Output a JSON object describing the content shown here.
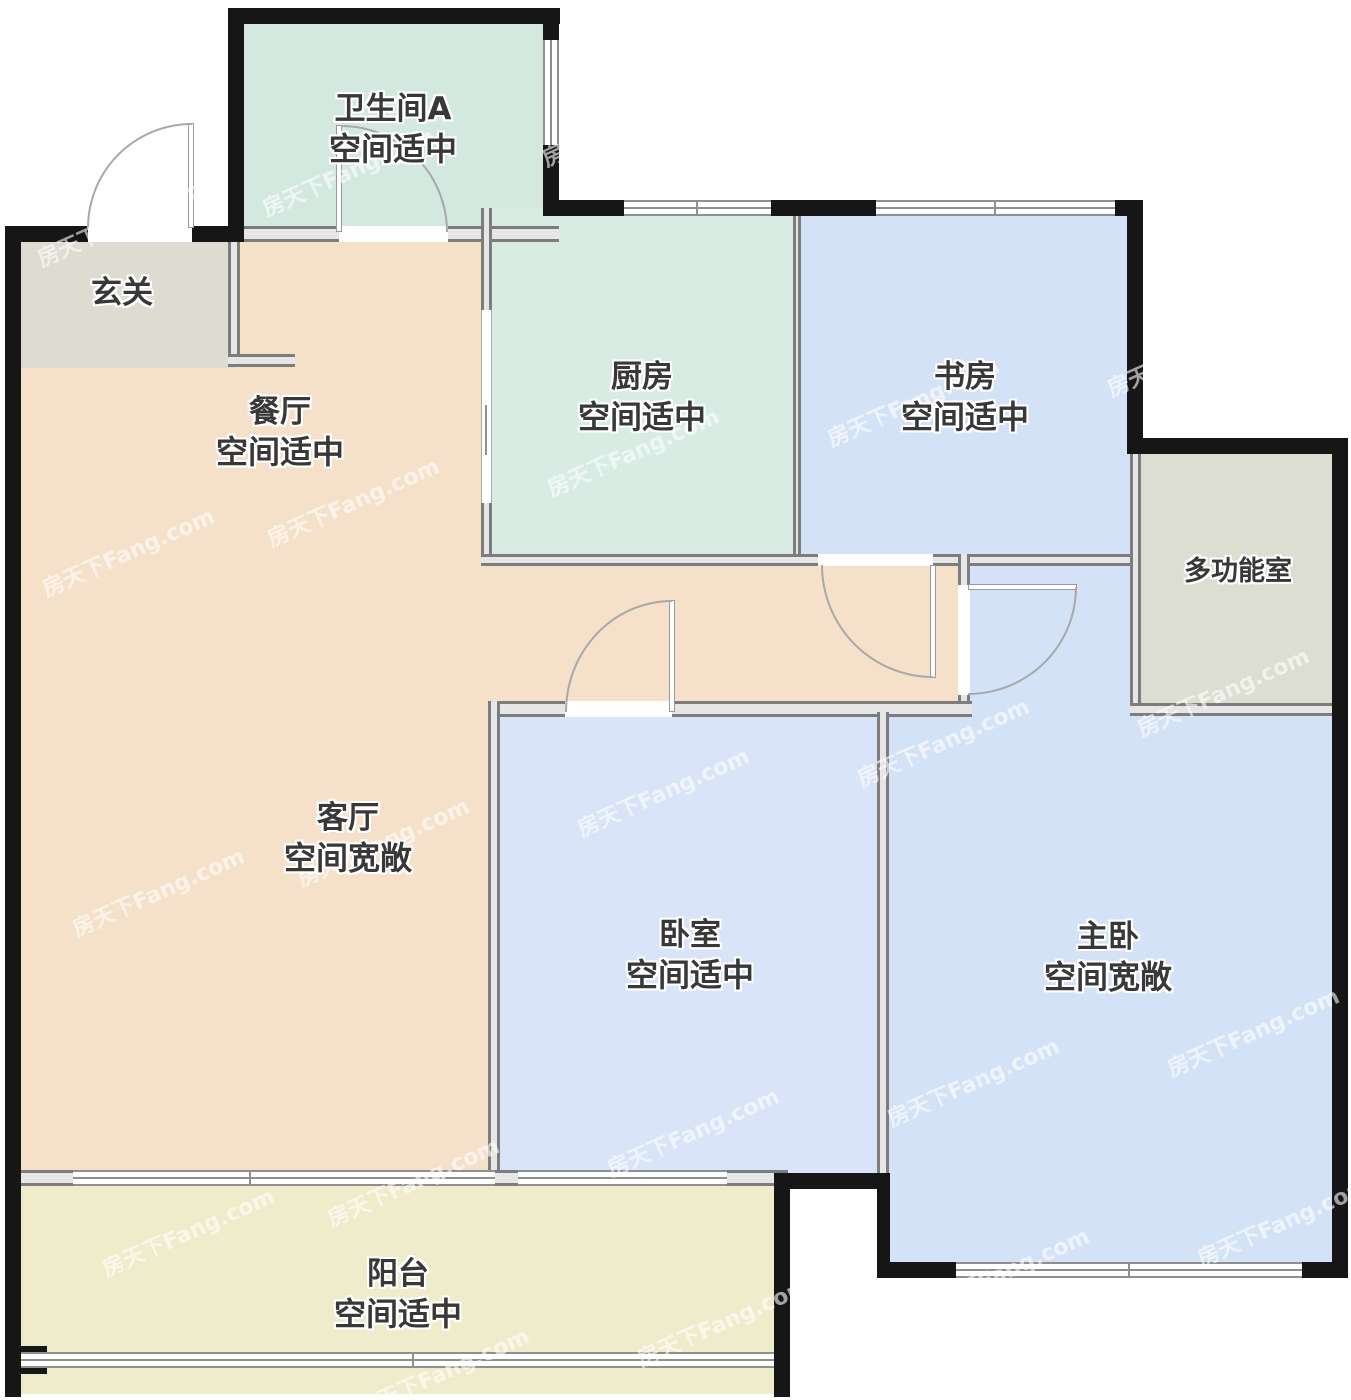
{
  "watermark": {
    "text": "房天下Fang.com"
  },
  "rooms": [
    {
      "name": "卫生间A",
      "note": "空间适中"
    },
    {
      "name": "玄关",
      "note": ""
    },
    {
      "name": "餐厅",
      "note": "空间适中"
    },
    {
      "name": "厨房",
      "note": "空间适中"
    },
    {
      "name": "书房",
      "note": "空间适中"
    },
    {
      "name": "多功能室",
      "note": ""
    },
    {
      "name": "客厅",
      "note": "空间宽敞"
    },
    {
      "name": "卧室",
      "note": "空间适中"
    },
    {
      "name": "主卧",
      "note": "空间宽敞"
    },
    {
      "name": "阳台",
      "note": "空间适中"
    }
  ],
  "colors": {
    "exterior_wall": "#161616",
    "interior_wall": "#7d7d7d",
    "bathroom": "#d3e9e0",
    "kitchen": "#d8ece4",
    "study": "#d4e2f8",
    "bedroom": "#d9e4f9",
    "master_bedroom": "#d4e2f8",
    "hallway": "#dedcd0",
    "multi_room": "#dbded0",
    "living_dining": "#f5e1ca",
    "balcony": "#eeeccb",
    "label_text": "#383838"
  }
}
